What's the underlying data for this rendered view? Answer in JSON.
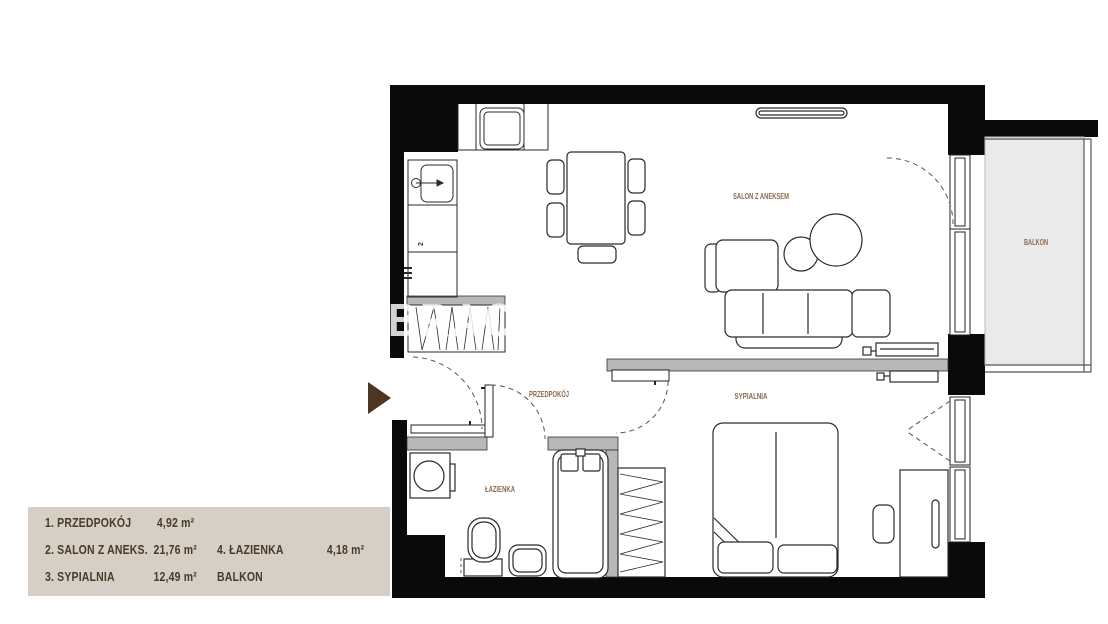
{
  "legend": {
    "items": [
      {
        "label": "1. PRZEDPOKÓJ",
        "area": "4,92 m²"
      },
      {
        "label": "2. SALON Z ANEKS.",
        "area": "21,76 m²"
      },
      {
        "label": "3. SYPIALNIA",
        "area": "12,49 m²"
      },
      {
        "label": "4. ŁAZIENKA",
        "area": "4,18 m²"
      },
      {
        "label": "BALKON",
        "area": ""
      }
    ]
  },
  "plan": {
    "room_labels": {
      "salon": "SALON Z ANEKSEM",
      "przedpokoj": "PRZEDPOKÓJ",
      "sypialnia": "SYPIALNIA",
      "lazienka": "ŁAZIENKA",
      "balkon": "BALKON",
      "kitchen_number": "2"
    },
    "watermark": "BRACH",
    "colors": {
      "wall": "#0a0a0a",
      "partition": "#b8b8b8",
      "balcony_floor": "#eaeaea",
      "legend_bg": "#d6cfc5",
      "legend_text": "#4a3a28",
      "room_label": "#8a6b50",
      "entrance_arrow": "#4e3522"
    }
  }
}
